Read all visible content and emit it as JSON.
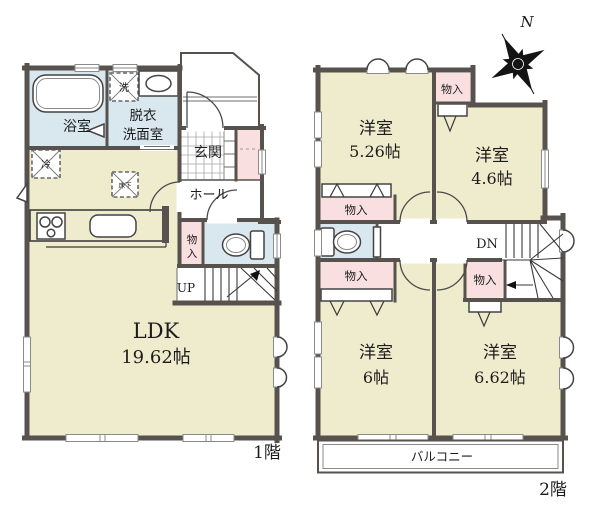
{
  "title": "間取り図",
  "colors": {
    "wall": "#57524d",
    "room_cream": "#efebcd",
    "wet_blue": "#d9e7ef",
    "closet_pink": "#f9dfdf",
    "background": "#ffffff"
  },
  "floor1": {
    "floor_label": "1階",
    "bath": "浴室",
    "dressing_line1": "脱衣",
    "dressing_line2": "洗面室",
    "entrance": "玄関",
    "hall": "ホール",
    "ldk_name": "LDK",
    "ldk_size": "19.62帖",
    "stairs": "UP",
    "storage_char1": "物",
    "storage_char2": "入",
    "washer": "洗",
    "fridge": "冷",
    "floor_hatch": "床下"
  },
  "floor2": {
    "floor_label": "2階",
    "room_nw_name": "洋室",
    "room_nw_size": "5.26帖",
    "room_ne_name": "洋室",
    "room_ne_size": "4.6帖",
    "room_sw_name": "洋室",
    "room_sw_size": "6帖",
    "room_se_name": "洋室",
    "room_se_size": "6.62帖",
    "closet_top": "物入",
    "closet_west_upper": "物入",
    "closet_west_lower": "物入",
    "closet_east": "物入",
    "stairs": "DN",
    "balcony": "バルコニー",
    "compass_north": "N"
  }
}
